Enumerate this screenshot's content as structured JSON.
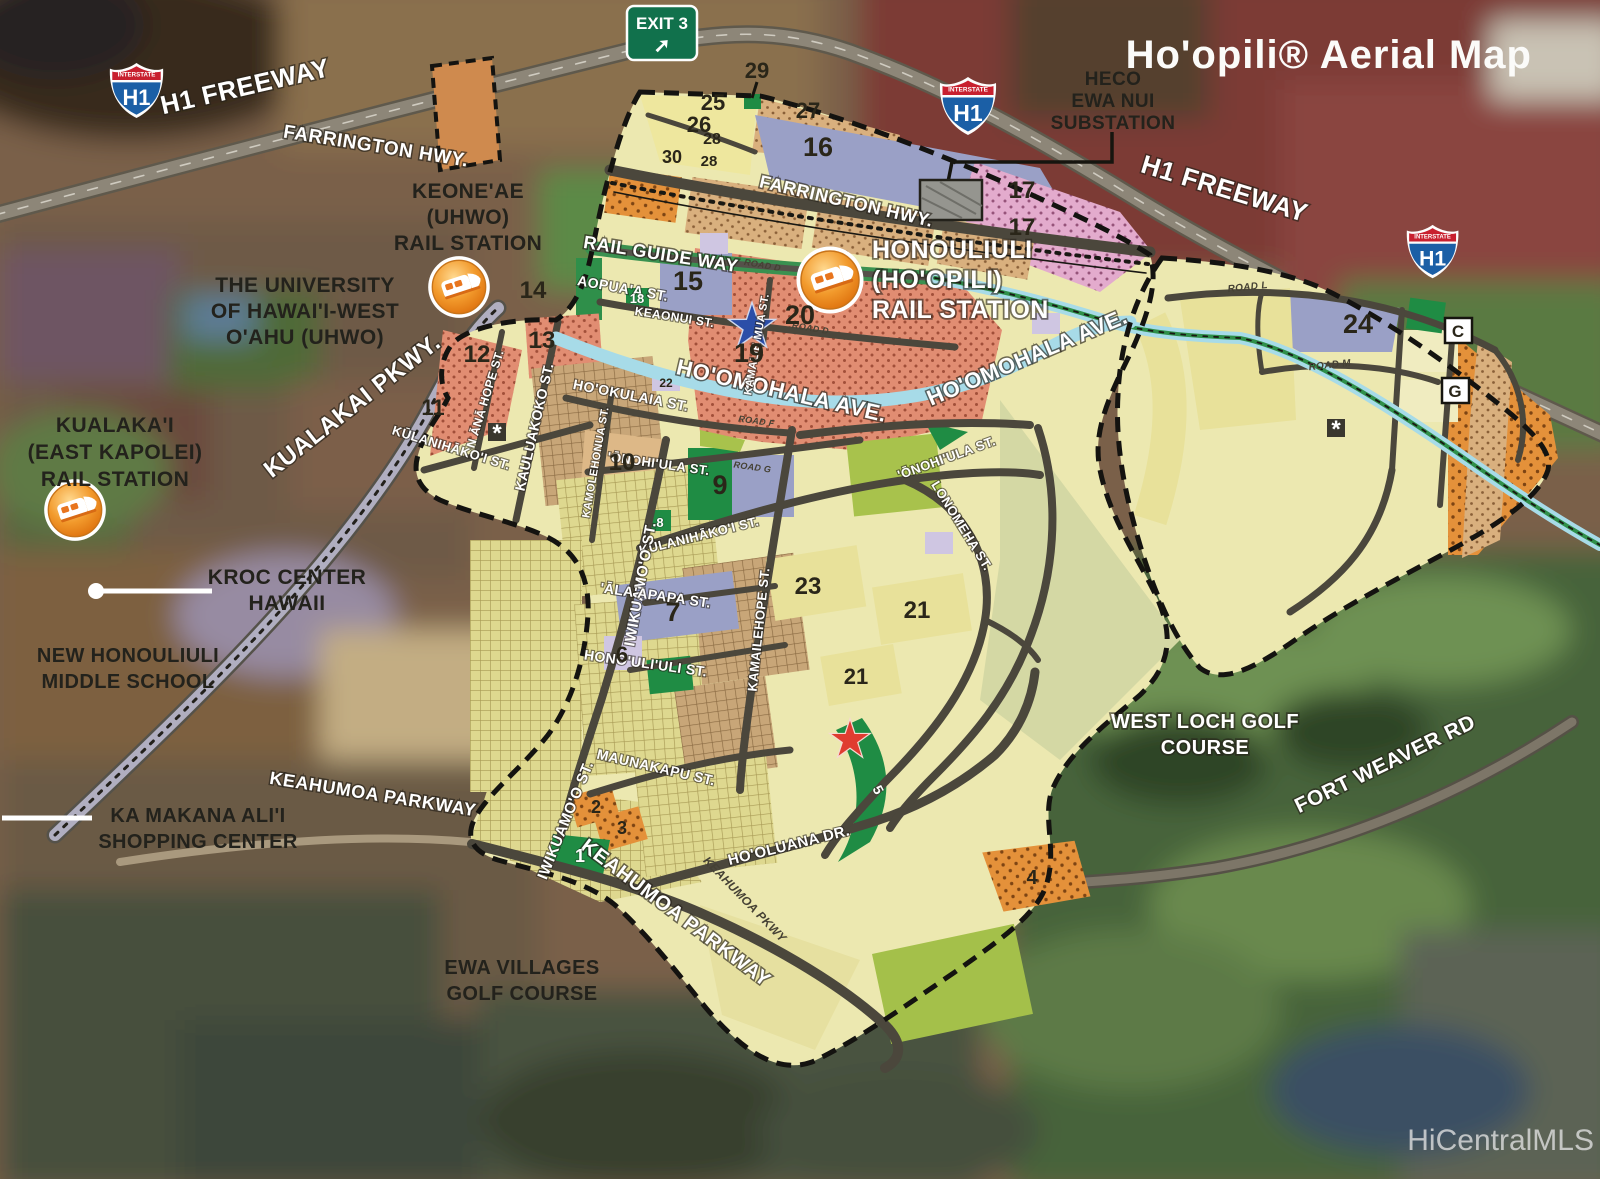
{
  "title": "Ho'opili® Aerial Map",
  "watermark": "HiCentralMLS",
  "exit_sign": {
    "label": "EXIT 3",
    "arrow": "➚"
  },
  "shield": {
    "top": "INTERSTATE",
    "route": "H1"
  },
  "highways": {
    "h1_left": "H1 FREEWAY",
    "h1_right": "H1 FREEWAY",
    "farrington_outer": "FARRINGTON HWY.",
    "farrington_inner": "FARRINGTON HWY.",
    "kualakai": "KUALAKAI PKWY.",
    "fort_weaver": "FORT WEAVER RD",
    "keahumoa_outer": "KEAHUMOA PARKWAY",
    "keahumoa_inner": "KEAHUMOA PARKWAY",
    "keahumoa_small": "KEAHUMOA PKWY",
    "rail_guide_way": "RAIL GUIDE WAY",
    "hoomohala_w": "HO'OMOHALA AVE.",
    "hoomohala_e": "HO'OMOHALA AVE."
  },
  "streets": {
    "aopuaa": "AOPUA'A ST.",
    "keaonui": "KEAONUI ST.",
    "nana_hope": "N ĀNĀ HOPE ST.",
    "kauluakoko": "KAULUAKOKO ST.",
    "hookulaia": "HO'OKULAIA ST.",
    "kulanihakoi_w": "KŪLANIHĀKO'I ST.",
    "kulanihakoi_e": "KŪLANIHĀKO'I ST.",
    "kamolehonua": "KAMOLEHONUA ST.",
    "kamalie_mua": "KAMALIE MUA ST.",
    "onohiula_w": "'ŌNOHI'ULA ST.",
    "onohiula_e": "'ŌNOHI'ULA ST.",
    "iwikuamoo_n": "IWIKUAMO'O ST.",
    "iwikuamoo_s": "IWIKUAMO'O ST.",
    "alaapapa": "'ĀLA'APAPA ST.",
    "honouliuli_st": "HONO'ULI'ULI ST.",
    "kamailehope": "KAMAILEHOPE ST.",
    "maunakapu": "MAUNAKAPU ST.",
    "lonomeha": "LONOMEHA ST.",
    "hooluana": "HO'OLUANA DR.",
    "road_d1": "ROAD D",
    "road_d2": "ROAD D",
    "road_f": "ROAD F",
    "road_g": "ROAD G",
    "road_l": "ROAD L",
    "road_m": "ROAD M"
  },
  "places": {
    "heco": [
      "HECO",
      "EWA NUI",
      "SUBSTATION"
    ],
    "keoneae": [
      "KEONE'AE",
      "(UHWO)",
      "RAIL STATION"
    ],
    "uhwo": [
      "THE UNIVERSITY",
      "OF HAWAI'I-WEST",
      "O'AHU (UHWO)"
    ],
    "kualakai_station": [
      "KUALAKA'I",
      "(EAST KAPOLEI)",
      "RAIL STATION"
    ],
    "honouliuli_station": [
      "HONOULIULI",
      "(HO'OPILI)",
      "RAIL STATION"
    ],
    "kroc": [
      "KROC CENTER",
      "HAWAII"
    ],
    "middle_school": [
      "NEW HONOULIULI",
      "MIDDLE SCHOOL"
    ],
    "ka_makana": [
      "KA MAKANA ALI'I",
      "SHOPPING CENTER"
    ],
    "ewa_villages": [
      "EWA VILLAGES",
      "GOLF COURSE"
    ],
    "west_loch": [
      "WEST LOCH GOLF",
      "COURSE"
    ]
  },
  "parcels": {
    "p29": "29",
    "p25": "25",
    "p26": "26",
    "p28a": "28",
    "p30": "30",
    "p28b": "28",
    "p27": "27",
    "p16": "16",
    "p17a": "17",
    "p17b": "17",
    "p14": "14",
    "p15": "15",
    "p18": "18",
    "p19": "19",
    "p20": "20",
    "p13": "13",
    "p12": "12",
    "p11": "11",
    "p22": "22",
    "p10": "10",
    "p9": "9",
    "p8": "8",
    "p24": "24",
    "p23": "23",
    "p21a": "21",
    "p21b": "21",
    "p7": "7",
    "p6": "6",
    "p5": "5",
    "p4": "4",
    "p3": "3",
    "p2": "2",
    "p1": "1",
    "pc": "C",
    "pg": "G"
  },
  "markers": [
    "*",
    "*"
  ],
  "colors": {
    "residential_salmon": "#e18d72",
    "dotted_tan": "#d9b07e",
    "dotted_pink": "#e3abcd",
    "dotted_orange": "#e4913a",
    "school_slate": "#9aa0c6",
    "park_green": "#1f8c44",
    "khaki": "#ded88f",
    "lime": "#a8c24c",
    "pale_site": "#ece8b0",
    "lavender": "#cfc6e2",
    "road_gray": "#4b473c",
    "water_blue": "#a7dbe8",
    "station_orange": "#e87d12",
    "boundary_black": "#141310",
    "sign_green": "#11714c",
    "shield_red": "#c8202f",
    "shield_blue": "#1b5fa6"
  }
}
